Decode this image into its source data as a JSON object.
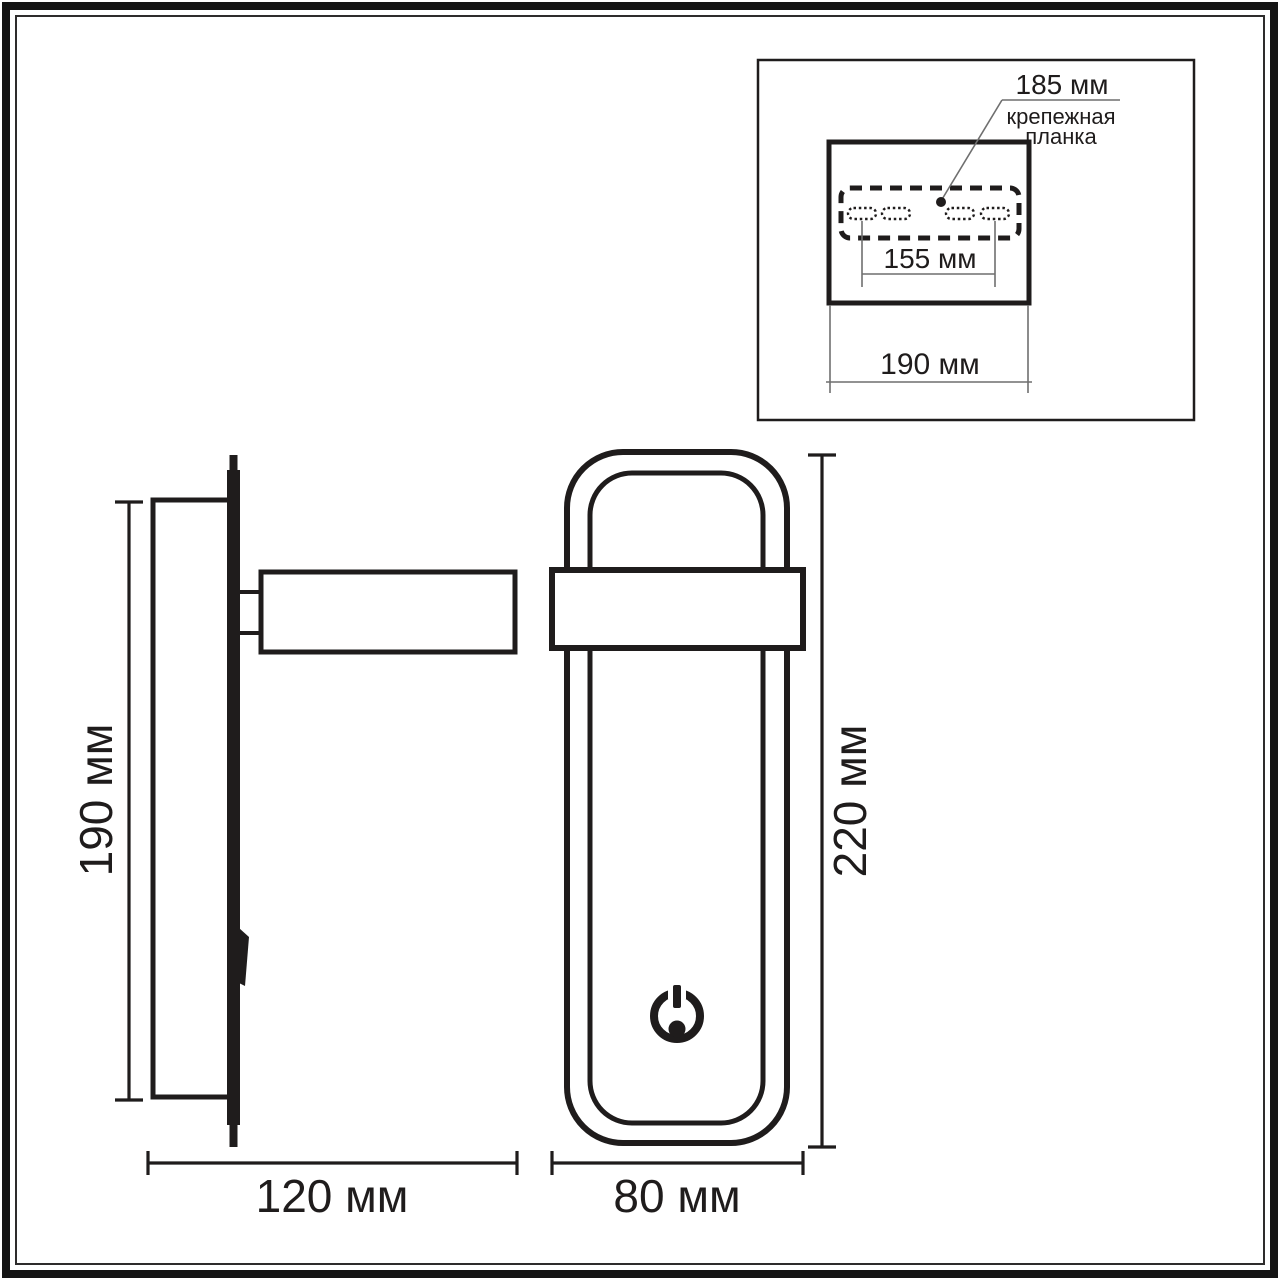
{
  "inset": {
    "bracket_width_label": "185 мм",
    "bracket_name_line1": "крепежная",
    "bracket_name_line2": "планка",
    "slot_spacing_label": "155 мм",
    "box_width_label": "190 мм"
  },
  "side_view": {
    "height_label": "190 мм",
    "depth_label": "120 мм"
  },
  "front_view": {
    "height_label": "220 мм",
    "width_label": "80 мм"
  },
  "icons": {
    "power": "power-icon"
  },
  "colors": {
    "line": "#1f1c1c",
    "thin_dim_line": "#6f6f6f",
    "background": "#ffffff"
  }
}
